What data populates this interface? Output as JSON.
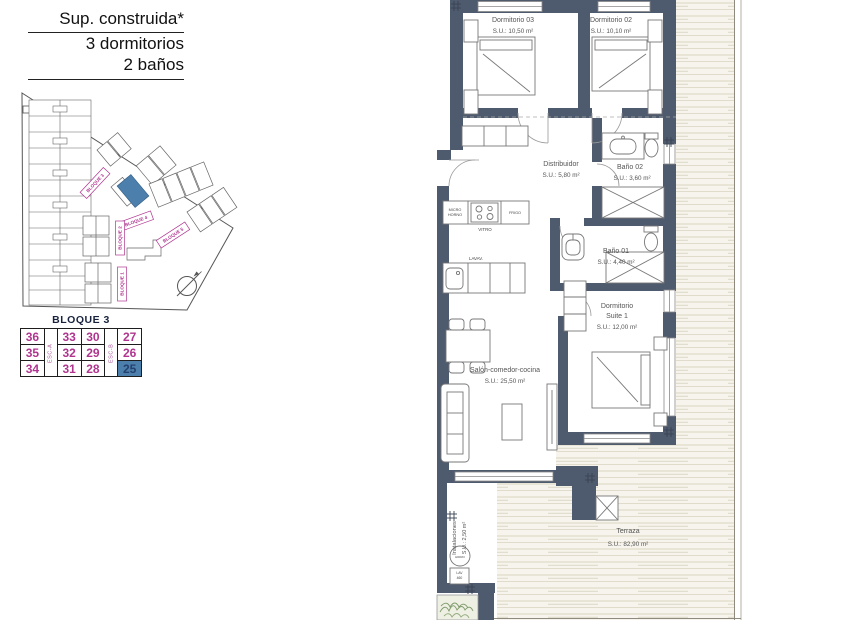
{
  "colors": {
    "wall": "#4e5a6d",
    "accent-pink": "#b0358f",
    "highlight-blue": "#4d7fad",
    "deck-bg": "#f6f4ec",
    "deck-line": "#d9d3c1",
    "plan-text": "#555555"
  },
  "header": {
    "line1": "Sup. construida*",
    "line2": "3 dormitorios",
    "line3": "2 baños"
  },
  "site_plan": {
    "bloque1": "BLOQUE 1",
    "bloque2": "BLOQUE 2",
    "bloque3": "BLOQUE 3",
    "bloque4": "BLOQUE 4",
    "bloque5": "BLOQUE 5"
  },
  "unit_table": {
    "title": "BLOQUE 3",
    "stair_a": "ESC-A",
    "stair_b": "ESC-B",
    "selected_unit": "25",
    "rows": [
      [
        "36",
        "33",
        "30",
        "27"
      ],
      [
        "35",
        "32",
        "29",
        "26"
      ],
      [
        "34",
        "31",
        "28",
        "25"
      ]
    ]
  },
  "plan": {
    "dorm03": {
      "name": "Dormitorio 03",
      "area": "S.U.: 10,50 m²"
    },
    "dorm02": {
      "name": "Dormitorio 02",
      "area": "S.U.: 10,10 m²"
    },
    "distribuidor": {
      "name": "Distribuidor",
      "area": "S.U.: 5,80 m²"
    },
    "bano02": {
      "name": "Baño 02",
      "area": "S.U.: 3,60 m²"
    },
    "bano01": {
      "name": "Baño 01",
      "area": "S.U.: 4,40 m²"
    },
    "suite": {
      "name1": "Dormitorio",
      "name2": "Suite 1",
      "area": "S.U.: 12,00 m²"
    },
    "salon": {
      "name": "Salón-comedor-cocina",
      "area": "S.U.: 25,50 m²"
    },
    "terraza": {
      "name": "Terraza",
      "area": "S.U.: 82,90 m²"
    },
    "instalaciones": {
      "name": "Instalaciones",
      "area": "S.U.: 2,50 m²"
    },
    "kitchen": {
      "micro1": "MICRO",
      "micro2": "HORNO",
      "vitro": "VITRO",
      "frigo": "FRIGO",
      "lavav": "LAVAV."
    },
    "utility": {
      "circle": "HIDRO",
      "box1": "LAV",
      "box2": "460"
    }
  }
}
